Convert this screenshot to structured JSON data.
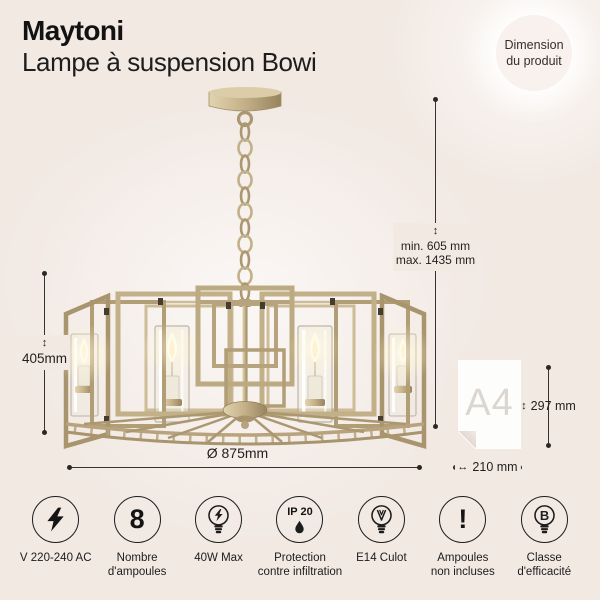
{
  "colors": {
    "background": "#f2e9e3",
    "brass": "#b7a37d",
    "text": "#1a1a1a",
    "badge_background": "#f8f1ed",
    "paper_label_gray": "#dcd6d1",
    "dimension_line": "#37322d"
  },
  "header": {
    "brand": "Maytoni",
    "product": "Lampe à suspension Bowi"
  },
  "badge": {
    "line1": "Dimension",
    "line2": "du produit"
  },
  "dimensions": {
    "suspension": {
      "arrow": "↕",
      "min": "min. 605 mm",
      "max": "max. 1435 mm"
    },
    "body_height": {
      "arrow": "↕",
      "value": "405mm"
    },
    "diameter": {
      "value": "Ø 875mm"
    },
    "reference": {
      "label": "A4",
      "height_arrow": "↕",
      "height": "297 mm",
      "width_arrow": "↔",
      "width": "210 mm"
    }
  },
  "specs": [
    {
      "name": "voltage",
      "icon": "lightning-icon",
      "glyph": "",
      "label1": "V 220-240 AC",
      "label2": ""
    },
    {
      "name": "bulb-count",
      "icon": "count-icon",
      "glyph": "8",
      "label1": "Nombre",
      "label2": "d'ampoules"
    },
    {
      "name": "max-power",
      "icon": "bulb-lightning-icon",
      "glyph": "",
      "label1": "40W Max",
      "label2": ""
    },
    {
      "name": "ip-rating",
      "icon": "ip-drop-icon",
      "glyph": "IP 20",
      "label1": "Protection",
      "label2": "contre infiltration"
    },
    {
      "name": "socket-type",
      "icon": "bulb-filament-icon",
      "glyph": "",
      "label1": "E14 Culot",
      "label2": ""
    },
    {
      "name": "bulbs-not-included",
      "icon": "exclamation-icon",
      "glyph": "!",
      "label1": "Ampoules",
      "label2": "non incluses"
    },
    {
      "name": "efficiency-class",
      "icon": "bulb-class-icon",
      "glyph": "B",
      "label1": "Classe",
      "label2": "d'efficacité"
    }
  ]
}
